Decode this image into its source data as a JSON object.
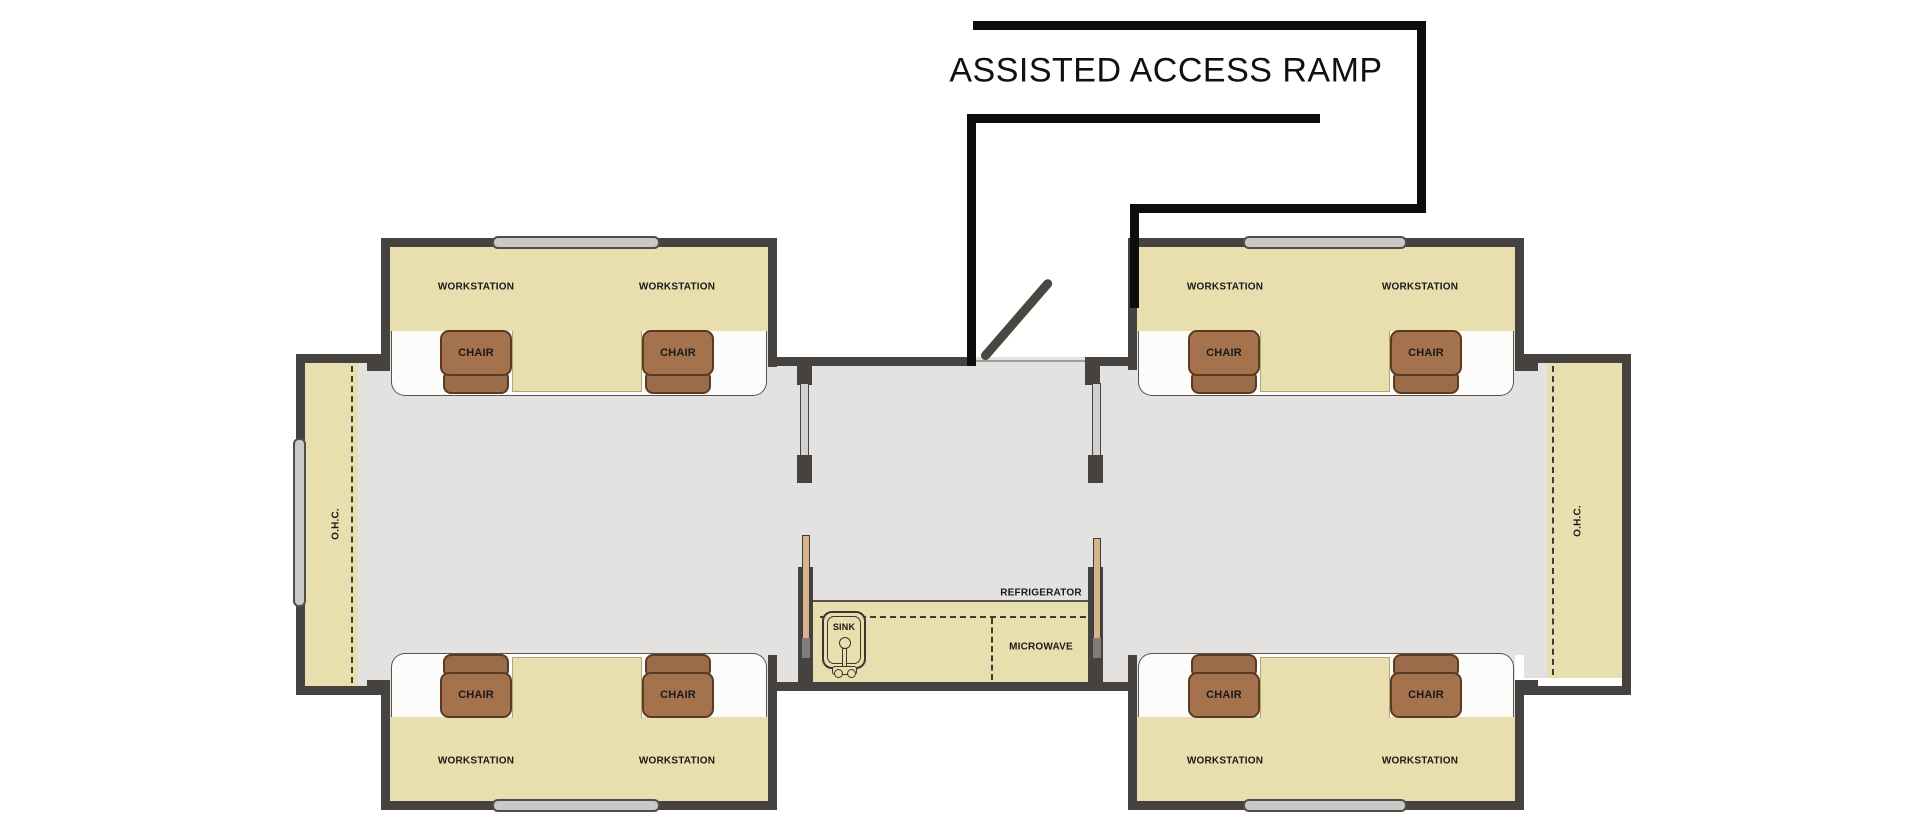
{
  "title": "ASSISTED ACCESS RAMP",
  "labels": {
    "workstation": "WORKSTATION",
    "chair": "CHAIR",
    "overhead_cabinet": "O.H.C.",
    "sink": "SINK",
    "microwave": "MICROWAVE",
    "refrigerator": "REFRIGERATOR"
  },
  "colors": {
    "wall": "#454240",
    "ramp_line": "#0d0d0d",
    "floor": "#e3e2e0",
    "desk_tan": "#e9deae",
    "chair_seat": "#a4724d",
    "chair_back": "#9b6c49",
    "chair_border": "#5c3a22",
    "window_fill": "#c9c9c7",
    "door_leaf": "#49473f",
    "inset_white": "#fcfcfa",
    "pocket_tan": "#d8b48d",
    "text": "#1a1a1a"
  },
  "counts": {
    "workstations": 8,
    "chairs": 8,
    "ohc_slideouts": 2,
    "units": 2
  }
}
